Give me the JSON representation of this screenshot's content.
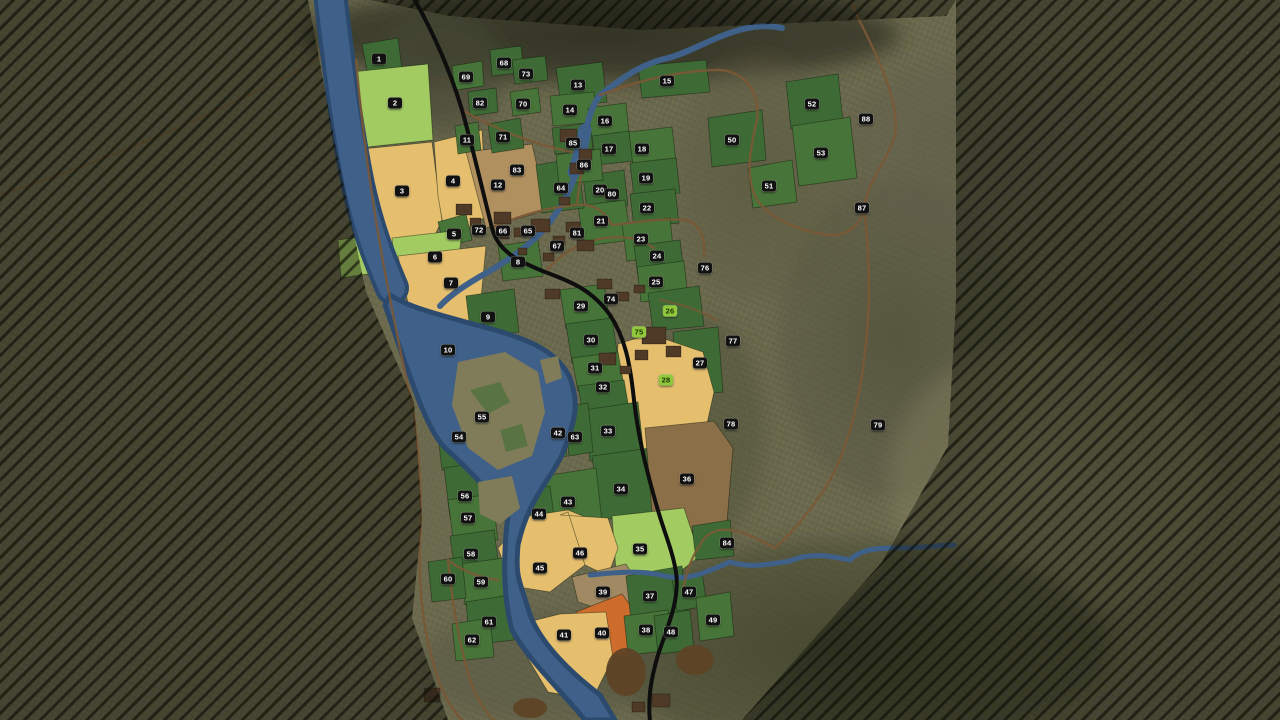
{
  "map": {
    "kind": "farming-overview-map",
    "palette": {
      "terrain": "#6c6a4e",
      "out_of_bounds": "#2e3120",
      "field_green": "#3e6b35",
      "field_green_alt": "#477439",
      "field_lightgreen": "#a2cb62",
      "field_wheat": "#e5bf6e",
      "field_orange": "#cd6c2d",
      "field_brown": "#8b6f48",
      "field_tanbrown": "#b0905f",
      "field_graybrown": "#a18a63",
      "building": "#4e3a26",
      "river": "#3f6088",
      "river_deep": "#2c4a6e",
      "road_paved": "#0e0e0e",
      "road_dirt": "#7b5836",
      "label_bg": "#111111",
      "label_text": "#ffffff",
      "label_owned_bg": "#8fc93a",
      "label_owned_text": "#1f3008"
    },
    "fields": [
      {
        "n": "1",
        "x": 379,
        "y": 59
      },
      {
        "n": "2",
        "x": 395,
        "y": 103
      },
      {
        "n": "3",
        "x": 402,
        "y": 191
      },
      {
        "n": "4",
        "x": 453,
        "y": 181
      },
      {
        "n": "5",
        "x": 454,
        "y": 234
      },
      {
        "n": "6",
        "x": 435,
        "y": 257
      },
      {
        "n": "7",
        "x": 451,
        "y": 283
      },
      {
        "n": "8",
        "x": 518,
        "y": 262
      },
      {
        "n": "9",
        "x": 488,
        "y": 317
      },
      {
        "n": "10",
        "x": 448,
        "y": 350
      },
      {
        "n": "11",
        "x": 467,
        "y": 140
      },
      {
        "n": "12",
        "x": 498,
        "y": 185
      },
      {
        "n": "13",
        "x": 578,
        "y": 85
      },
      {
        "n": "14",
        "x": 570,
        "y": 110
      },
      {
        "n": "15",
        "x": 667,
        "y": 81
      },
      {
        "n": "16",
        "x": 605,
        "y": 121
      },
      {
        "n": "17",
        "x": 609,
        "y": 149
      },
      {
        "n": "18",
        "x": 642,
        "y": 149
      },
      {
        "n": "19",
        "x": 646,
        "y": 178
      },
      {
        "n": "20",
        "x": 600,
        "y": 190
      },
      {
        "n": "21",
        "x": 601,
        "y": 221
      },
      {
        "n": "22",
        "x": 647,
        "y": 208
      },
      {
        "n": "23",
        "x": 641,
        "y": 239
      },
      {
        "n": "24",
        "x": 657,
        "y": 256
      },
      {
        "n": "25",
        "x": 656,
        "y": 282
      },
      {
        "n": "26",
        "x": 670,
        "y": 311,
        "owned": true
      },
      {
        "n": "27",
        "x": 700,
        "y": 363
      },
      {
        "n": "28",
        "x": 666,
        "y": 380,
        "owned": true
      },
      {
        "n": "29",
        "x": 581,
        "y": 306
      },
      {
        "n": "30",
        "x": 591,
        "y": 340
      },
      {
        "n": "31",
        "x": 595,
        "y": 368
      },
      {
        "n": "32",
        "x": 603,
        "y": 387
      },
      {
        "n": "33",
        "x": 608,
        "y": 431
      },
      {
        "n": "34",
        "x": 621,
        "y": 489
      },
      {
        "n": "35",
        "x": 640,
        "y": 549
      },
      {
        "n": "36",
        "x": 687,
        "y": 479
      },
      {
        "n": "37",
        "x": 650,
        "y": 596
      },
      {
        "n": "38",
        "x": 646,
        "y": 630
      },
      {
        "n": "39",
        "x": 603,
        "y": 592
      },
      {
        "n": "40",
        "x": 602,
        "y": 633
      },
      {
        "n": "41",
        "x": 564,
        "y": 635
      },
      {
        "n": "42",
        "x": 558,
        "y": 433
      },
      {
        "n": "43",
        "x": 568,
        "y": 502
      },
      {
        "n": "44",
        "x": 539,
        "y": 514
      },
      {
        "n": "45",
        "x": 540,
        "y": 568
      },
      {
        "n": "46",
        "x": 580,
        "y": 553
      },
      {
        "n": "47",
        "x": 689,
        "y": 592
      },
      {
        "n": "48",
        "x": 671,
        "y": 632
      },
      {
        "n": "49",
        "x": 713,
        "y": 620
      },
      {
        "n": "50",
        "x": 732,
        "y": 140
      },
      {
        "n": "51",
        "x": 769,
        "y": 186
      },
      {
        "n": "52",
        "x": 812,
        "y": 104
      },
      {
        "n": "53",
        "x": 821,
        "y": 153
      },
      {
        "n": "54",
        "x": 459,
        "y": 437
      },
      {
        "n": "55",
        "x": 482,
        "y": 417
      },
      {
        "n": "56",
        "x": 465,
        "y": 496
      },
      {
        "n": "57",
        "x": 468,
        "y": 518
      },
      {
        "n": "58",
        "x": 471,
        "y": 554
      },
      {
        "n": "59",
        "x": 481,
        "y": 582
      },
      {
        "n": "60",
        "x": 448,
        "y": 579
      },
      {
        "n": "61",
        "x": 489,
        "y": 622
      },
      {
        "n": "62",
        "x": 472,
        "y": 640
      },
      {
        "n": "63",
        "x": 575,
        "y": 437
      },
      {
        "n": "64",
        "x": 561,
        "y": 188
      },
      {
        "n": "65",
        "x": 528,
        "y": 231
      },
      {
        "n": "66",
        "x": 503,
        "y": 231
      },
      {
        "n": "67",
        "x": 557,
        "y": 246
      },
      {
        "n": "68",
        "x": 504,
        "y": 63
      },
      {
        "n": "69",
        "x": 466,
        "y": 77
      },
      {
        "n": "70",
        "x": 523,
        "y": 104
      },
      {
        "n": "71",
        "x": 503,
        "y": 137
      },
      {
        "n": "72",
        "x": 479,
        "y": 230
      },
      {
        "n": "73",
        "x": 526,
        "y": 74
      },
      {
        "n": "74",
        "x": 611,
        "y": 299
      },
      {
        "n": "75",
        "x": 639,
        "y": 332,
        "owned": true
      },
      {
        "n": "76",
        "x": 705,
        "y": 268
      },
      {
        "n": "77",
        "x": 733,
        "y": 341
      },
      {
        "n": "78",
        "x": 731,
        "y": 424
      },
      {
        "n": "79",
        "x": 878,
        "y": 425
      },
      {
        "n": "80",
        "x": 612,
        "y": 194
      },
      {
        "n": "81",
        "x": 577,
        "y": 233
      },
      {
        "n": "82",
        "x": 480,
        "y": 103
      },
      {
        "n": "83",
        "x": 517,
        "y": 170
      },
      {
        "n": "84",
        "x": 727,
        "y": 543
      },
      {
        "n": "85",
        "x": 573,
        "y": 143
      },
      {
        "n": "86",
        "x": 584,
        "y": 165
      },
      {
        "n": "87",
        "x": 862,
        "y": 208
      },
      {
        "n": "88",
        "x": 866,
        "y": 119
      }
    ]
  }
}
